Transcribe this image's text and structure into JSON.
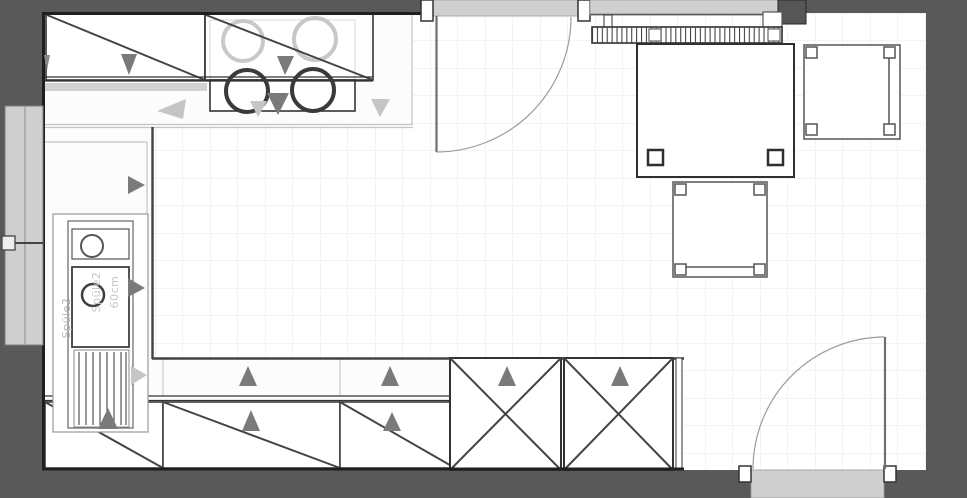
{
  "plan": {
    "type": "kitchen-floor-plan",
    "colors": {
      "background": "#595959",
      "floor": "#ffffff",
      "grid": "#e7e7ee",
      "wall_line": "#1f1f1f",
      "cabinet_outline": "#333333",
      "counter_edge_light": "#c3c3c9",
      "counter_front_dark": "#424242",
      "window_fill": "#cfcfcf",
      "arrow_dark": "#7a7a7a",
      "arrow_light": "#c5c5c5",
      "label_text": "#b5b5b5"
    },
    "symbols": [
      "wall-cabinet",
      "base-cabinet",
      "tall-cabinet",
      "cooktop-burner",
      "oven",
      "sink",
      "faucet",
      "drainer",
      "dining-table",
      "chair",
      "radiator",
      "door-swing",
      "window",
      "opening-direction-arrow"
    ]
  },
  "sink": {
    "cabinet_label": "Spüle2",
    "item_label": "Spüle2",
    "width_label": "60cm"
  }
}
